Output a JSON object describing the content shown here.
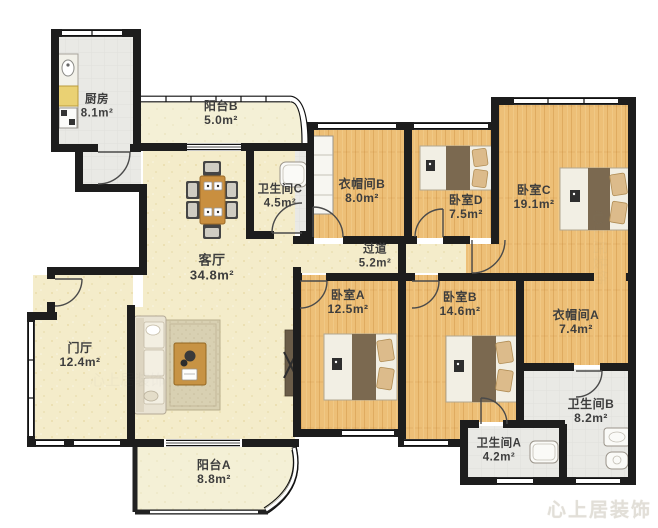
{
  "watermark": {
    "text": "心上居装饰"
  },
  "palette": {
    "wall": "#1d1d1d",
    "wood_floor": "#edbf77",
    "cream_floor": "#f4ecca",
    "balcony_floor": "#f4f0d6",
    "tile_floor": "#e9e9e5",
    "label_text": "#3d3d3d"
  },
  "rooms": {
    "kitchen": {
      "label": "厨房",
      "area": "8.1m²"
    },
    "balcony_b": {
      "label": "阳台B",
      "area": "5.0m²"
    },
    "bathroom_c": {
      "label": "卫生间C",
      "area": "4.5m²"
    },
    "cloakroom_b": {
      "label": "衣帽间B",
      "area": "8.0m²"
    },
    "bedroom_d": {
      "label": "卧室D",
      "area": "7.5m²"
    },
    "bedroom_c": {
      "label": "卧室C",
      "area": "19.1m²"
    },
    "hallway": {
      "label": "过道",
      "area": "5.2m²"
    },
    "living": {
      "label": "客厅",
      "area": "34.8m²"
    },
    "bedroom_a": {
      "label": "卧室A",
      "area": "12.5m²"
    },
    "bedroom_b": {
      "label": "卧室B",
      "area": "14.6m²"
    },
    "cloakroom_a": {
      "label": "衣帽间A",
      "area": "7.4m²"
    },
    "foyer": {
      "label": "门厅",
      "area": "12.4m²"
    },
    "bathroom_b": {
      "label": "卫生间B",
      "area": "8.2m²"
    },
    "bathroom_a": {
      "label": "卫生间A",
      "area": "4.2m²"
    },
    "balcony_a": {
      "label": "阳台A",
      "area": "8.8m²"
    }
  }
}
